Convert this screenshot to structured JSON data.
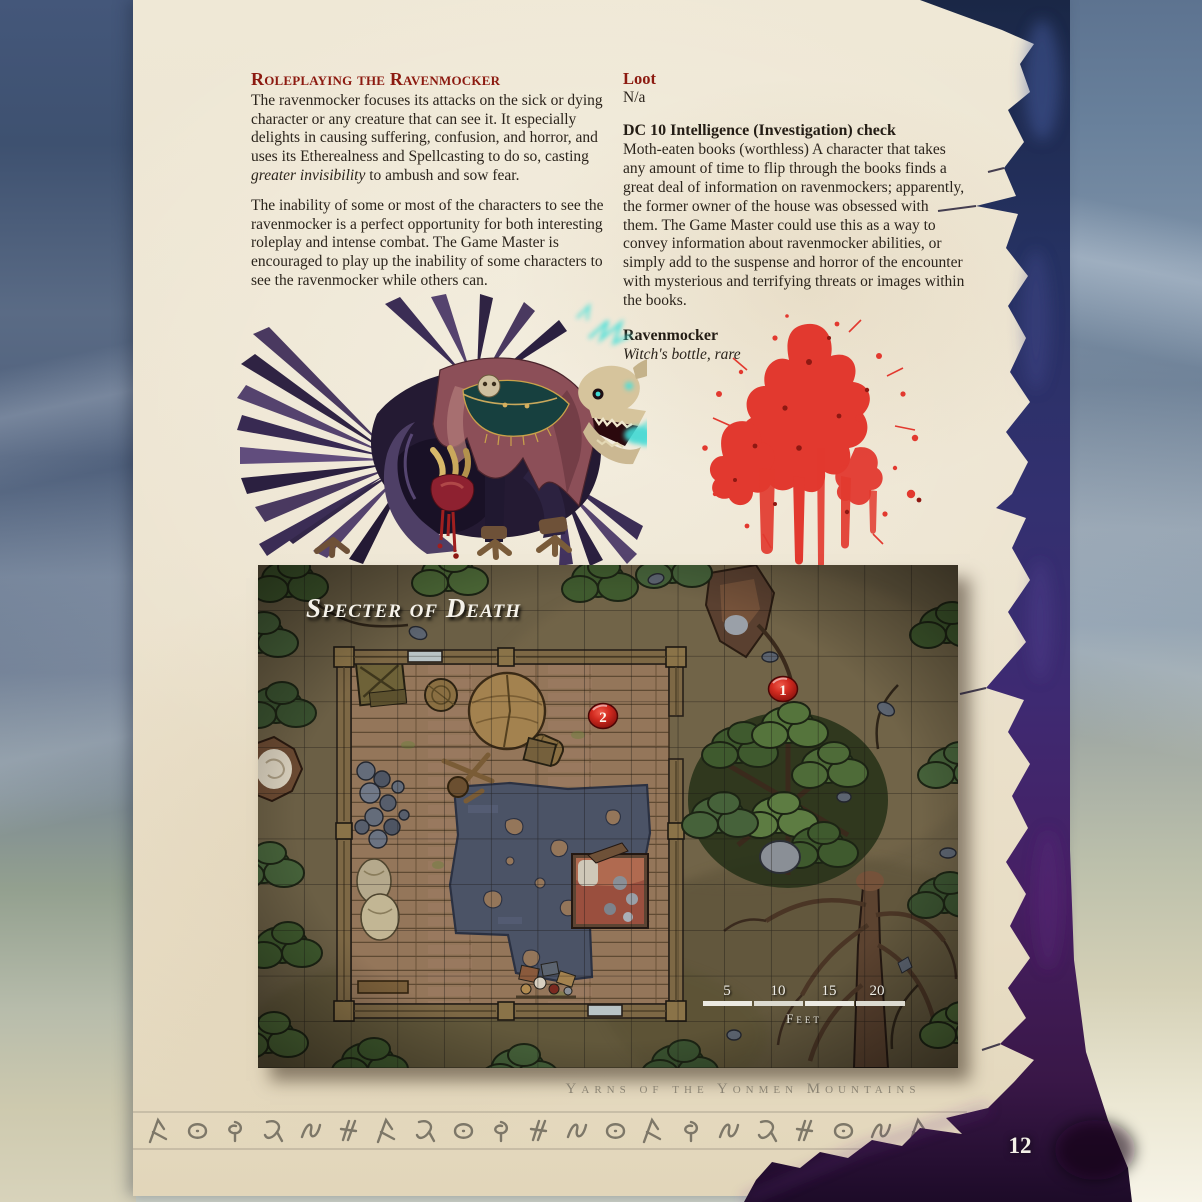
{
  "page": {
    "number": "12",
    "footer": "Yarns of the Yonmen Mountains"
  },
  "article": {
    "roleplaying": {
      "heading": "Roleplaying the Ravenmocker",
      "para1_a": "The ravenmocker focuses its attacks on the sick or dying character or any creature that can see it. It especially delights in causing suffering, confusion, and horror, and uses its Etherealness and Spellcasting to do so, casting ",
      "para1_italic": "greater invisibility",
      "para1_b": " to ambush and sow fear.",
      "para2": "The inability of some or most of the characters to see the ravenmocker is a perfect opportunity for both interesting roleplay and intense combat. The Game Master is encouraged to play up the inability of some characters to see the ravenmocker while others can."
    },
    "loot": {
      "heading": "Loot",
      "value": "N/a"
    },
    "check": {
      "heading": "DC 10 Intelligence (Investigation) check",
      "body": "Moth-eaten books (worthless) A character that takes any amount of time to flip through the books finds a great deal of information on ravenmockers; apparently, the former owner of the house was obsessed with them. The Game Master could use this as a way to convey information about ravenmocker abilities, or simply add to the suspense and horror of the encounter with mysterious and terrifying threats or images within the books."
    },
    "item": {
      "name": "Ravenmocker",
      "type": "Witch's bottle, rare"
    }
  },
  "map": {
    "title": "Specter of Death",
    "markers": [
      {
        "label": "1"
      },
      {
        "label": "2"
      }
    ],
    "scale_ticks": [
      "5",
      "10",
      "15",
      "20"
    ],
    "scale_unit": "Feet"
  },
  "colors": {
    "heading_red": "#8c1a10",
    "marker_red": "#c41a14",
    "parchment": "#ece3cf",
    "torn_navy": "#263263",
    "torn_violet": "#471f63",
    "blood_red": "#e2392f",
    "rune_ink": "#6c675a"
  }
}
